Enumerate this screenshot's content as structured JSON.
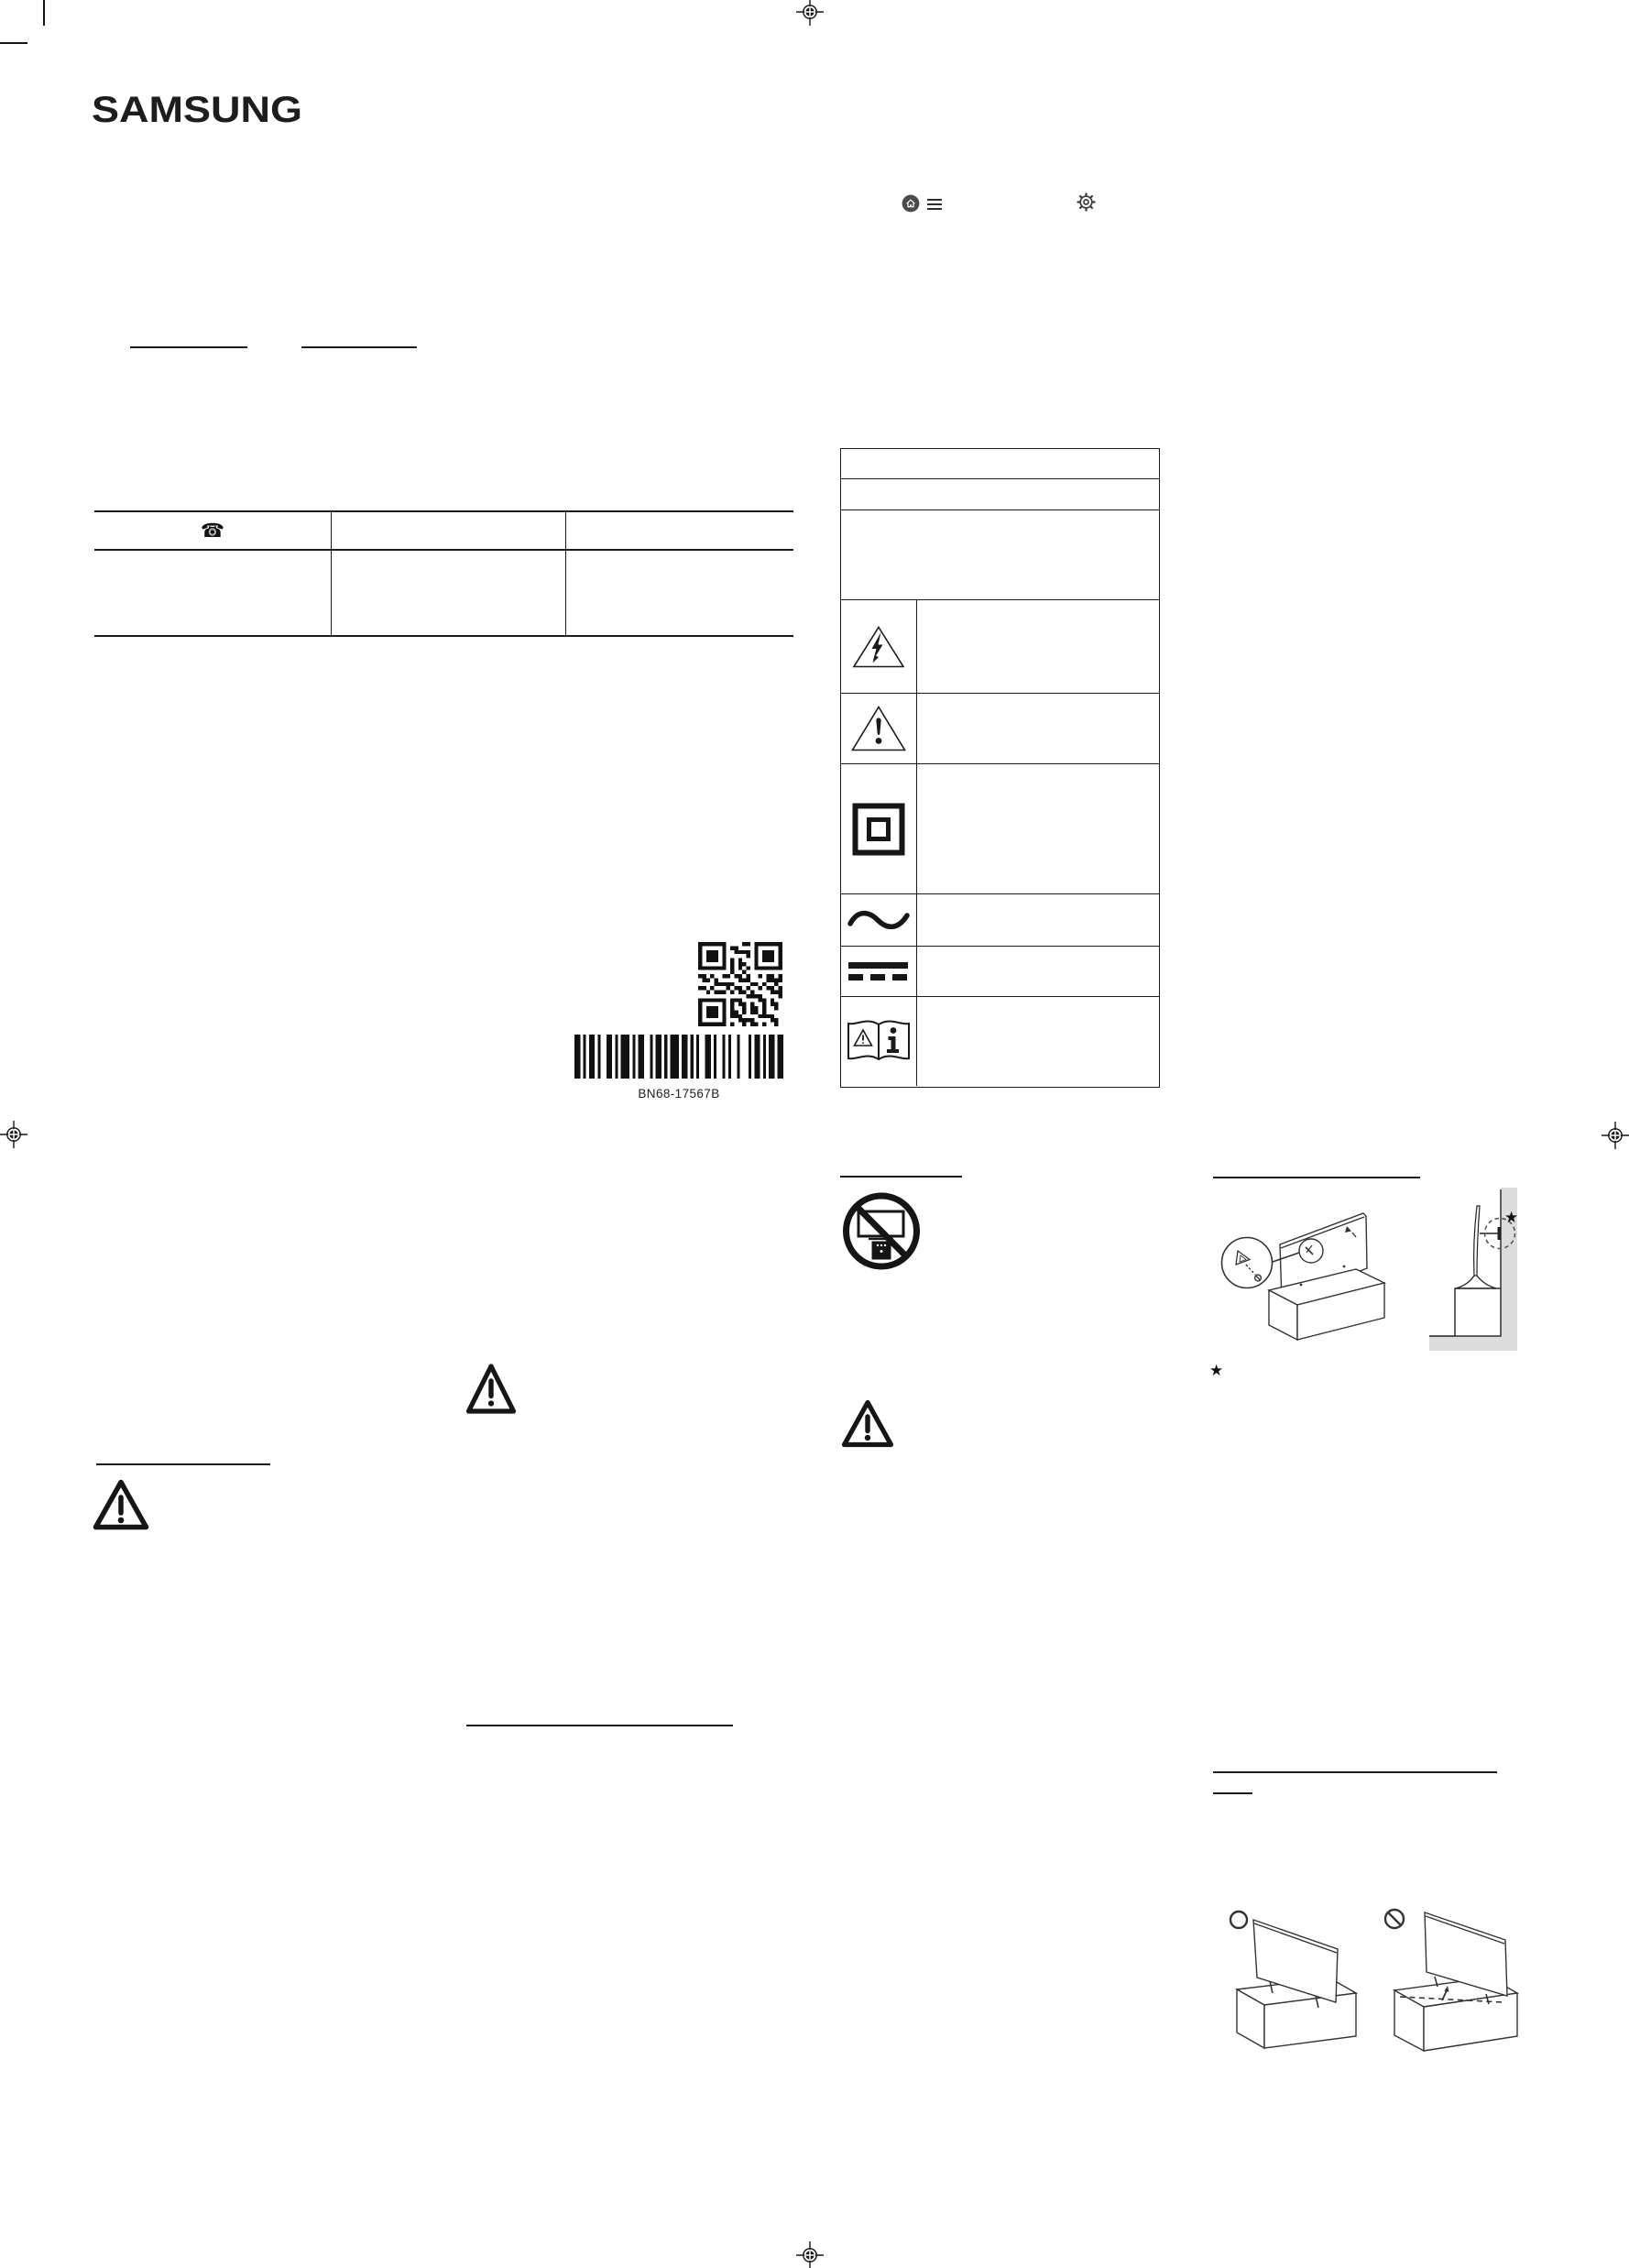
{
  "page": {
    "paper_color": "#ffffff",
    "ink_color": "#1a1a1a",
    "wall_shade_color": "#dcdcdc"
  },
  "brand": {
    "logo_text": "SAMSUNG"
  },
  "smart_hub_icons": {
    "home": "home-icon",
    "menu": "menu-icon",
    "settings": "gear-icon"
  },
  "glyphs": {
    "telephone": "☎",
    "footnote_star": "★"
  },
  "support_table": {
    "column_count": 3,
    "header_icon": "telephone-icon"
  },
  "symbols_table": {
    "symbol_rows": [
      "high-voltage-triangle-icon",
      "caution-triangle-icon",
      "class-ii-double-square-icon",
      "ac-voltage-wave-icon",
      "dc-voltage-bars-icon",
      "refer-to-manual-icon"
    ]
  },
  "codes": {
    "qr": "qr-code",
    "barcode": "barcode",
    "part_number": "BN68-17567B"
  },
  "installation": {
    "correct_marker": "allowed-circle-icon",
    "prohibited_marker": "prohibited-circle-icon",
    "do_not_place_icon": "no-tv-on-unstable-furniture-icon",
    "anti_tip_illustration": "anti-tip-bracket-illustration",
    "wall_gap_illustration": "tv-near-wall-side-view-illustration",
    "front_placement_illustration": "tv-at-front-of-cabinet-illustration",
    "back_placement_illustration": "tv-at-back-of-cabinet-illustration"
  }
}
